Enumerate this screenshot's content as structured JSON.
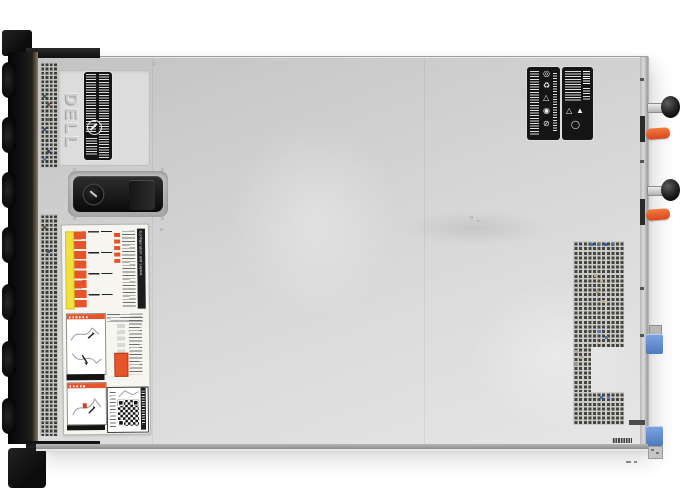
{
  "meta": {
    "description": "Top-down product photo of a Dell 1U rack-mount server chassis (top cover view) on a white background",
    "image_type": "product-photo",
    "background_color": "#ffffff"
  },
  "brand": {
    "logo_text": "DELL"
  },
  "chassis": {
    "body_color": "#d5d5d5",
    "front_bezel_color": "#131313",
    "bezel_trim_color": "#8b7a66",
    "side_rail_color": "#b6b6b6",
    "vent_hole_color": "#45453c",
    "rack_ear_count": 2,
    "front_drive_bumps": 7
  },
  "cover_latch": {
    "plate_color": "#141414",
    "lock_icon": "keyed-lock-icon"
  },
  "labels": {
    "info_label": {
      "base_color": "#151515",
      "text_legible": false,
      "symbol": "prohibition-circle-icon"
    },
    "service_label": {
      "title": "Configuration and Layout",
      "base_color": "#f7f5f0",
      "accent_orange": "#e8542a",
      "accent_yellow": "#f2e13c",
      "has_qr_code": true,
      "sections": [
        "memory-configuration-map",
        "service-instruction-diagrams",
        "service-instruction-diagrams",
        "qr-information-panel"
      ]
    },
    "regulatory": {
      "count": 2,
      "base_color": "#161616",
      "left_glyphs": [
        "◎",
        "♻",
        "△",
        "◉",
        "⊘"
      ],
      "right_glyphs": [
        "△",
        "▲",
        "◯"
      ]
    }
  },
  "psu": {
    "count": 2,
    "handle_grip_color": "#1d1d1d",
    "release_tab_color": "#e8542a"
  },
  "rear": {
    "latch_tab_color": "#5f8ccc",
    "latch_count": 2
  }
}
